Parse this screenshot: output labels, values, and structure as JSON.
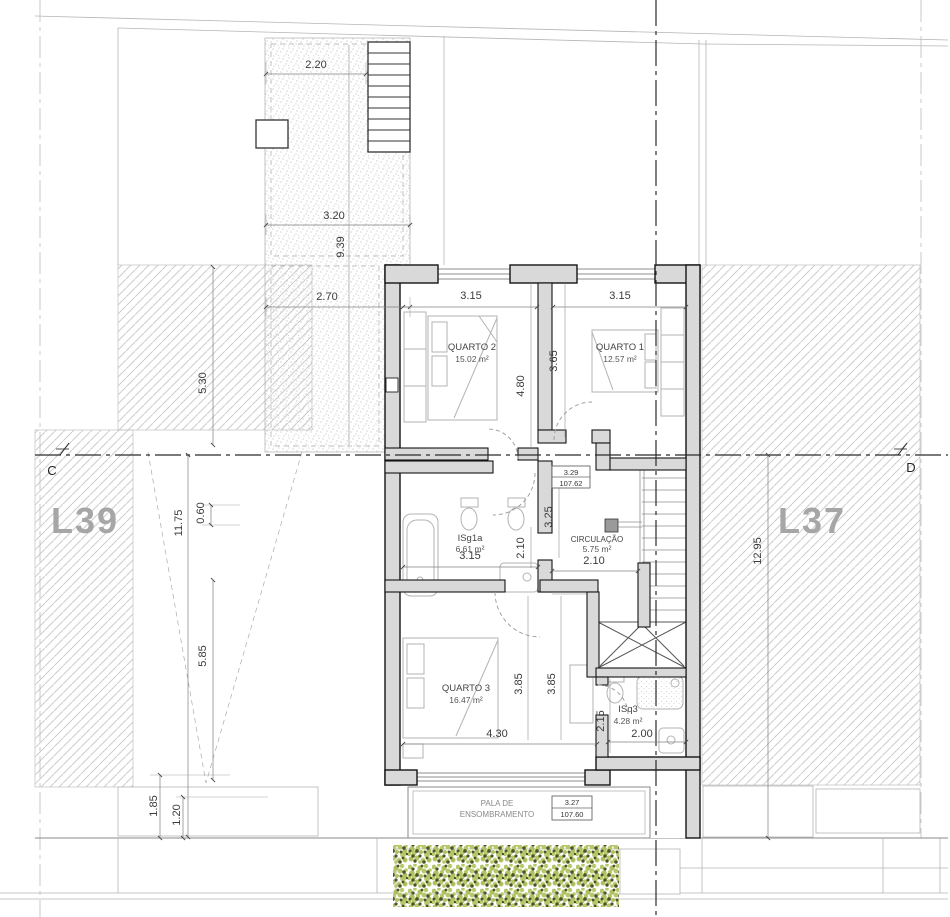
{
  "lots": {
    "left": "L39",
    "right": "L37"
  },
  "section_markers": {
    "left": "C",
    "right": "D"
  },
  "rooms": {
    "quarto2": {
      "name": "QUARTO 2",
      "area": "15.02 m²"
    },
    "quarto1": {
      "name": "QUARTO 1",
      "area": "12.57 m²"
    },
    "isg1a": {
      "name": "ISg1a",
      "area": "6.61 m²"
    },
    "circulacao": {
      "name": "CIRCULAÇÃO",
      "area": "5.75 m²"
    },
    "quarto3": {
      "name": "QUARTO 3",
      "area": "16.47 m²"
    },
    "isq3": {
      "name": "ISq3",
      "area": "4.28 m²"
    }
  },
  "pala": {
    "line1": "PALA DE",
    "line2": "ENSOMBRAMENTO"
  },
  "levels": {
    "upper_rel": "3.29",
    "upper_abs": "107.62",
    "lower_rel": "3.27",
    "lower_abs": "107.60"
  },
  "dims": {
    "patio_top": "2.20",
    "patio_mid": "3.20",
    "patio_vertical": "9.39",
    "patio_bottom": "2.70",
    "left_upper": "5.30",
    "left_total": "11.75",
    "left_offset": "0.60",
    "left_lower": "5.85",
    "bottom_a": "1.85",
    "bottom_b": "1.20",
    "right_total": "12.95",
    "q2_width": "3.15",
    "q1_width": "3.15",
    "q2_depth": "4.80",
    "q1_depth": "3.65",
    "hall_depth": "3.25",
    "isg1a_width": "3.15",
    "isg1a_door": "2.10",
    "circ_width": "2.10",
    "q3_width": "4.30",
    "q3_depth_a": "3.85",
    "q3_depth_b": "3.85",
    "isq3_depth": "2.15",
    "isq3_width": "2.00"
  },
  "colors": {
    "wall_fill": "#d9d9d9",
    "hedge_light": "#b7c86b",
    "hedge_dark": "#4d5526",
    "lot_label": "#a6a6a6"
  }
}
